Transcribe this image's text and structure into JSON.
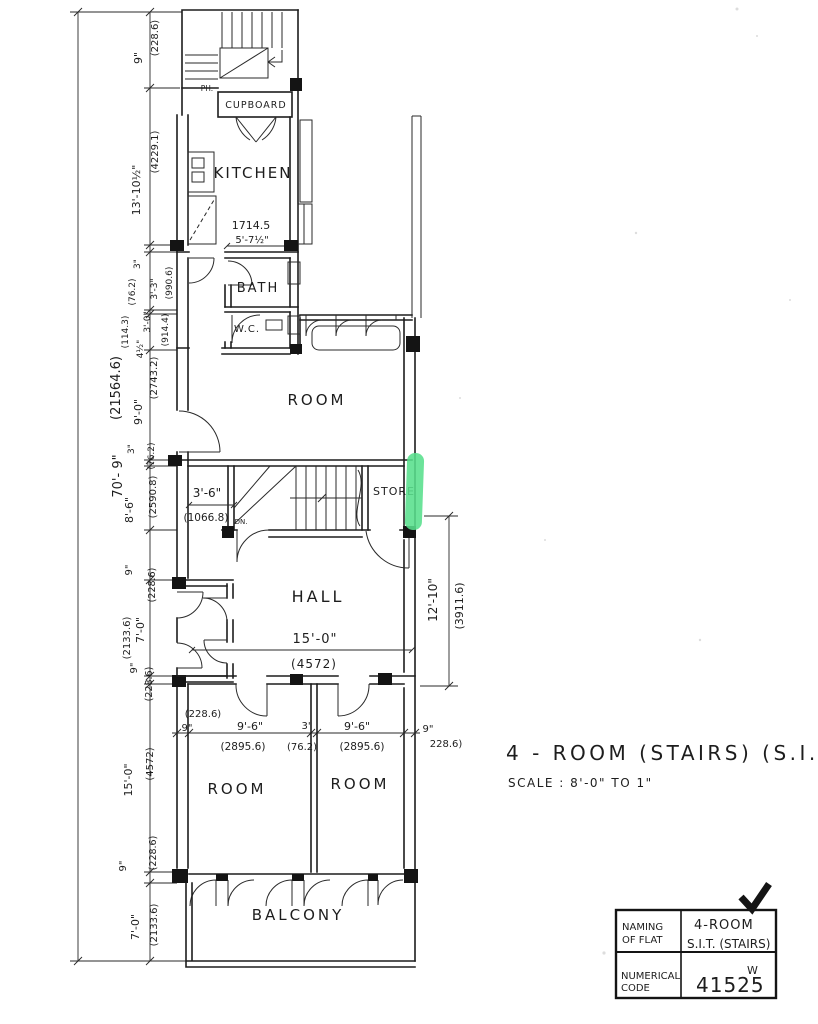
{
  "title": {
    "name": "4 - ROOM  (STAIRS)  (S.I.T)",
    "scale": "SCALE :  8'-0\" TO 1\""
  },
  "rooms": {
    "kitchen": "KITCHEN",
    "cupboard": "CUPBOARD",
    "bath": "BATH",
    "wc": "W.C.",
    "room_upper": "ROOM",
    "store": "STORE",
    "hall": "HALL",
    "room_left": "ROOM",
    "room_right": "ROOM",
    "balcony": "BALCONY",
    "ph": "PH.",
    "dn": "DN."
  },
  "dims": {
    "overall": {
      "ft": "70'- 9\"",
      "mm": "(21564.6)"
    },
    "l1": {
      "ft": "9\"",
      "mm": "(228.6)"
    },
    "l2": {
      "ft": "13'-10½\"",
      "mm": "(4229.1)"
    },
    "l3a": {
      "ft": "4½\"",
      "mm": "(114.3)"
    },
    "l3b": {
      "ft": "3'-0\"",
      "mm": "(914.4)"
    },
    "l3c": {
      "ft": "3\"",
      "mm": "(76.2)"
    },
    "l3d": {
      "ft": "3'-3\"",
      "mm": "(990.6)"
    },
    "l4": {
      "ft": "9'-0\"",
      "mm": "(2743.2)"
    },
    "l5": {
      "ft": "3\"",
      "mm": "(76.2)"
    },
    "l6": {
      "ft": "8'-6\"",
      "mm": "(2590.8)"
    },
    "l7": {
      "ft": "9\"",
      "mm": "(228.6)"
    },
    "l8": {
      "ft": "7'-0\"",
      "mm": "(2133.6)"
    },
    "l9": {
      "ft": "9\"",
      "mm": "(228.6)"
    },
    "l10": {
      "ft": "15'-0\"",
      "mm": "(4572)"
    },
    "l11": {
      "ft": "9\"",
      "mm": "(228.6)"
    },
    "l12": {
      "ft": "7'-0\"",
      "mm": "(2133.6)"
    },
    "kitchen_w": {
      "mm": "1714.5",
      "ft": "5'-7½\""
    },
    "stair_w": {
      "ft": "3'-6\"",
      "mm": "(1066.8)"
    },
    "hall_w": {
      "ft": "15'-0\"",
      "mm": "(4572)"
    },
    "hall_side": {
      "ft": "12'-10\"",
      "mm": "(3911.6)"
    },
    "b0": {
      "mm": "(228.6)",
      "ft": "9\""
    },
    "b1": {
      "ft": "9'-6\"",
      "mm": "(2895.6)"
    },
    "b2": {
      "ft": "3\"",
      "mm": "(76.2)"
    },
    "b3": {
      "ft": "9'-6\"",
      "mm": "(2895.6)"
    },
    "b4": {
      "ft": "9\"",
      "mm": "228.6)"
    }
  },
  "legend": {
    "naming_label_1": "NAMING",
    "naming_label_2": "OF FLAT",
    "naming_value_1": "4-ROOM",
    "naming_value_2": "S.I.T. (STAIRS)",
    "code_label_1": "NUMERICAL",
    "code_label_2": "CODE",
    "code_value": "41525",
    "code_superscript": "W"
  },
  "colors": {
    "ink": "#1d1d1d",
    "paper": "#ffffff",
    "highlight": "#58DF8C"
  }
}
